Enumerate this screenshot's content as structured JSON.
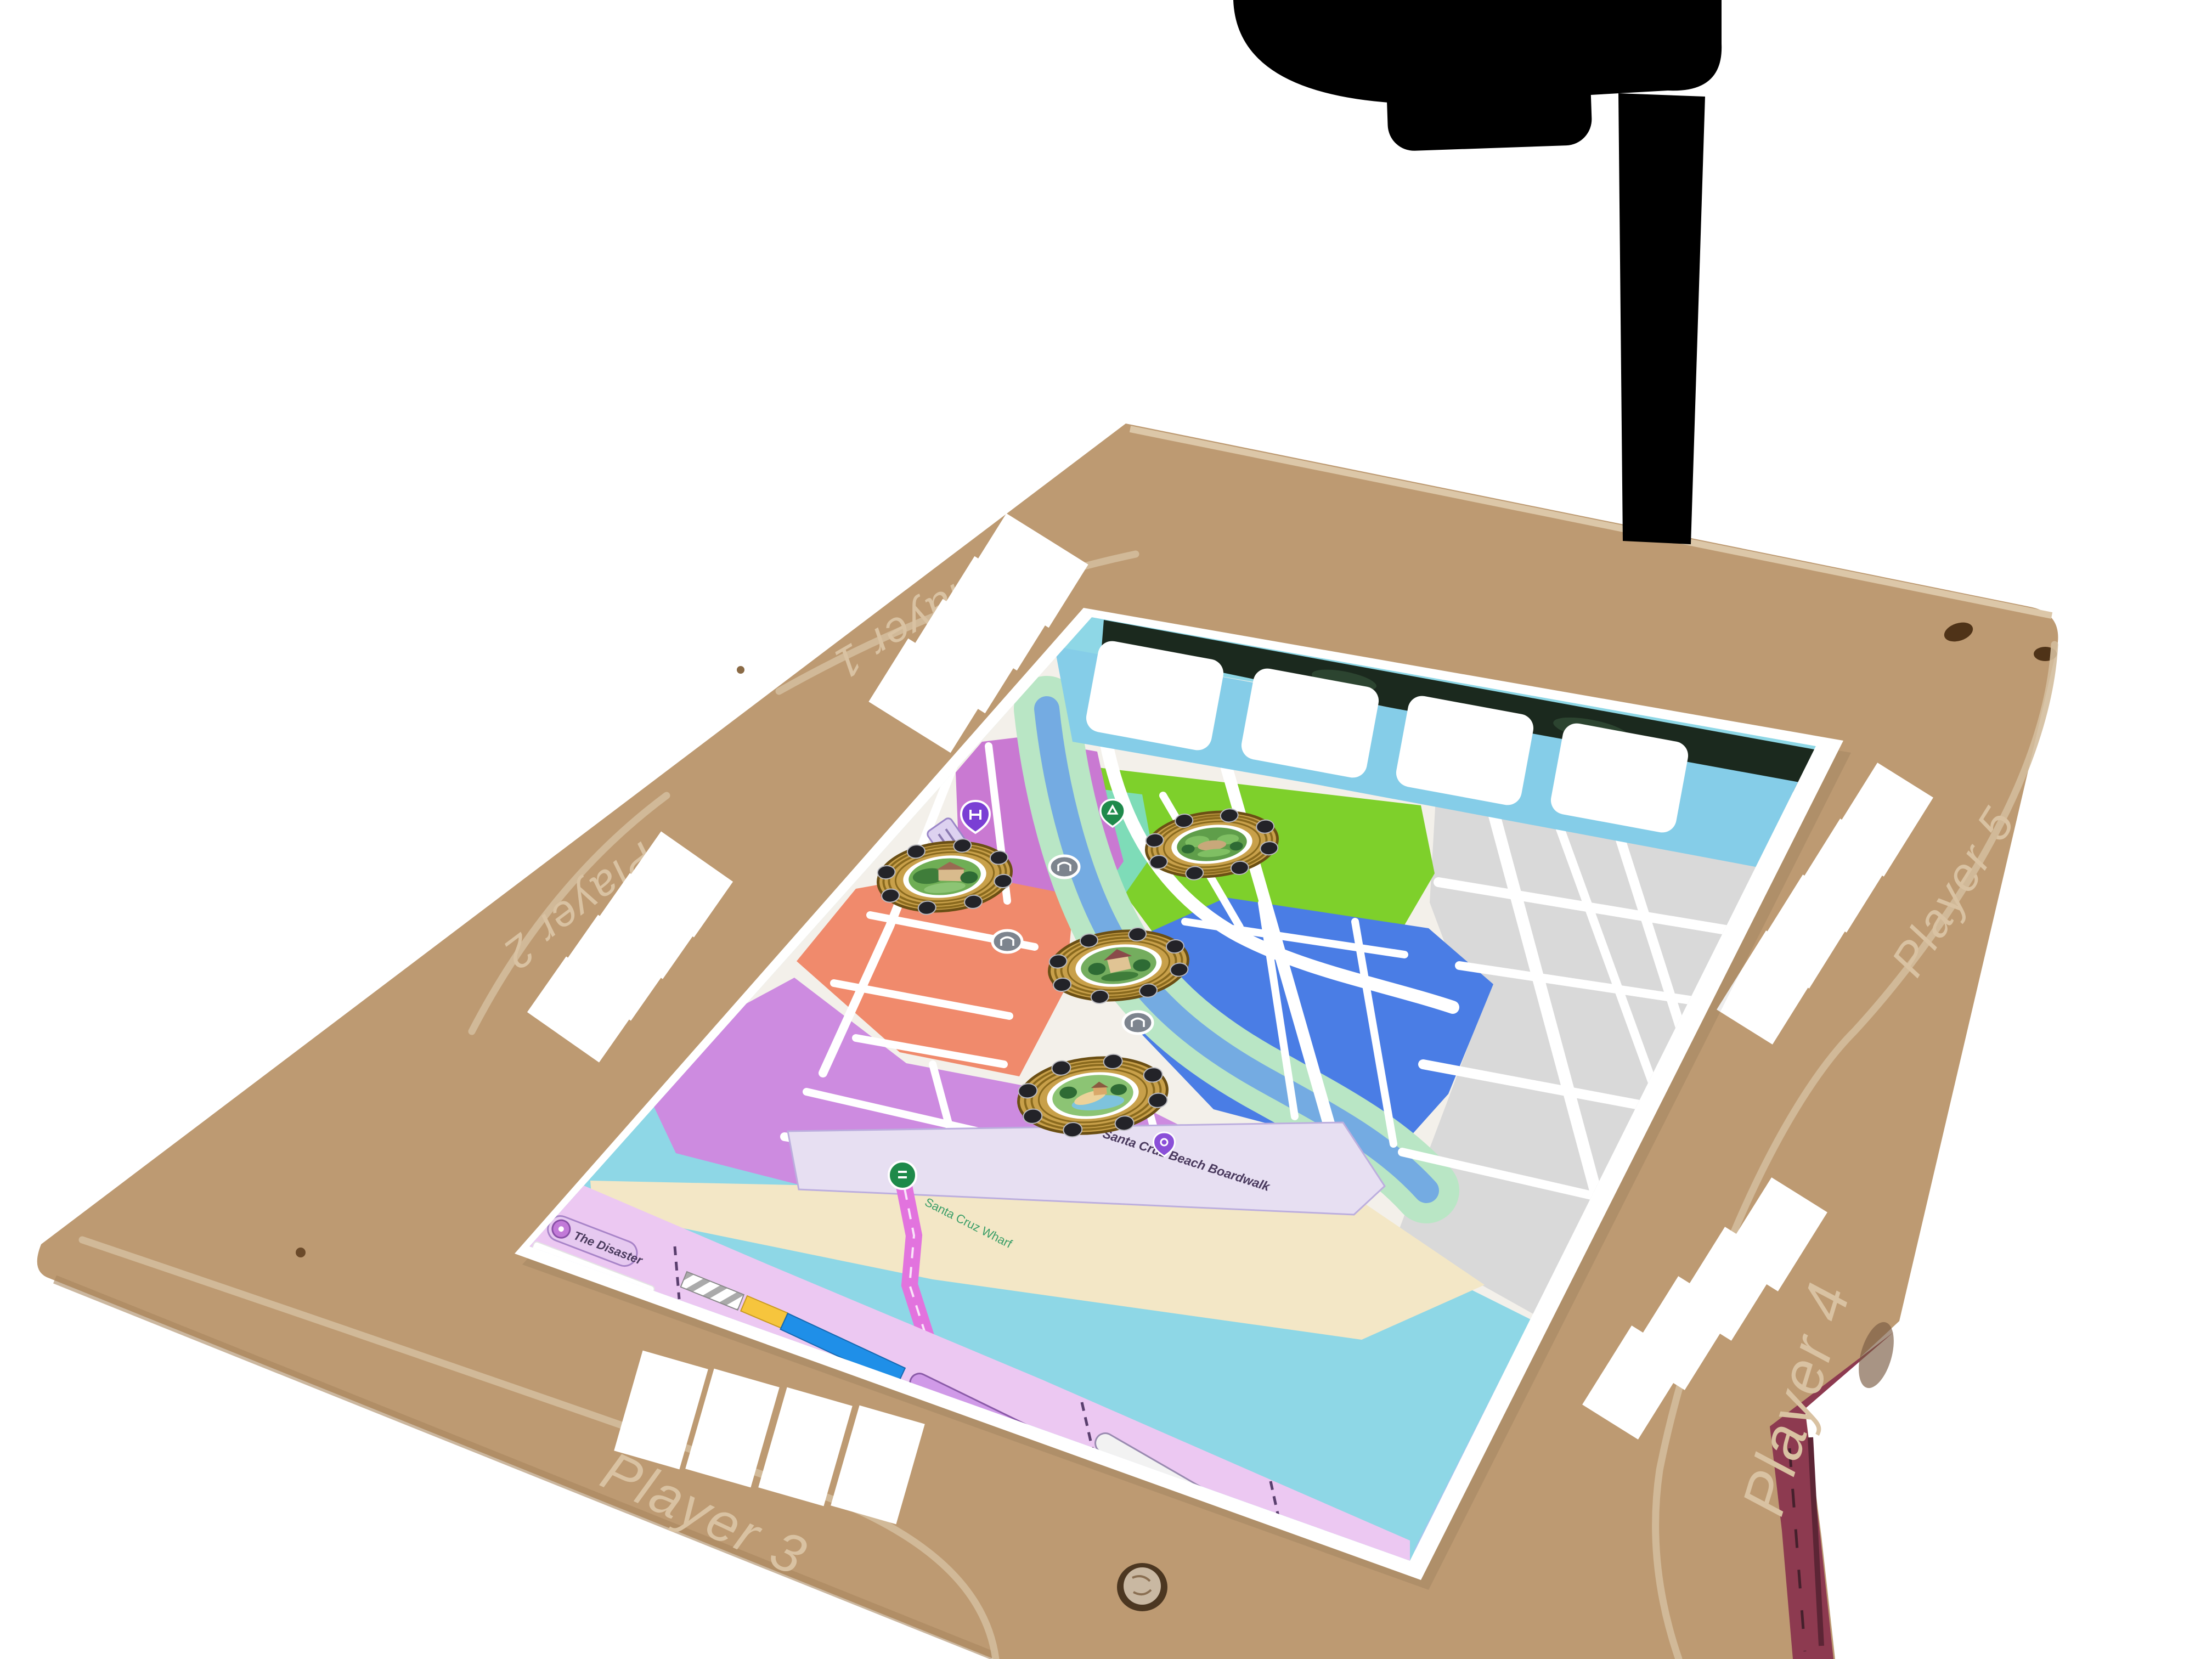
{
  "board": {
    "material": "cardboard",
    "surface_color": "#bd9a72",
    "handwriting_color": "#d9c2a2",
    "edge_wear_color": "#8d3a50",
    "player_areas": [
      {
        "label": "Player 1",
        "position": "top-edge",
        "card_slots": 4
      },
      {
        "label": "Player 2",
        "position": "left-edge",
        "card_slots": 4
      },
      {
        "label": "Player 3",
        "position": "bottom-edge",
        "card_slots": 4
      },
      {
        "label": "Player 4",
        "position": "right-edge-lower",
        "card_slots": 4
      },
      {
        "label": "Player 5",
        "position": "right-edge-upper",
        "card_slots": 4
      }
    ]
  },
  "map_sheet": {
    "top_card_slots": 4,
    "tokens": [
      {
        "name": "estate-token",
        "district": "riverside-west"
      },
      {
        "name": "park-token",
        "district": "green-park"
      },
      {
        "name": "house-token",
        "district": "blue-east"
      },
      {
        "name": "beach-token",
        "district": "boardwalk-south"
      }
    ],
    "legend": {
      "title": "The Disaster",
      "tracks": [
        {
          "label": "PREPARATION",
          "style": "striped-bar"
        },
        {
          "label": "FLOODZONE",
          "style": "yellow-blue-bar"
        },
        {
          "label": "RECOVERY",
          "style": "purple-pill"
        },
        {
          "label": "COMMUNITY RESILIENCE",
          "style": "white-pill"
        }
      ]
    },
    "landmarks": [
      {
        "label": "Santa Cruz Beach Boardwalk"
      },
      {
        "label": "Santa Cruz Wharf"
      }
    ],
    "district_colors": {
      "magenta": "#c979d2",
      "salmon": "#f08a6c",
      "purple": "#cd8be0",
      "park_green": "#7ed02b",
      "blue": "#4a7de5",
      "gray": "#d9d9d9",
      "water": "#8ed7e6",
      "beach": "#f3e7c6",
      "river": "#74abe2"
    }
  },
  "equipment": {
    "overhead_arm_color": "#000000"
  }
}
